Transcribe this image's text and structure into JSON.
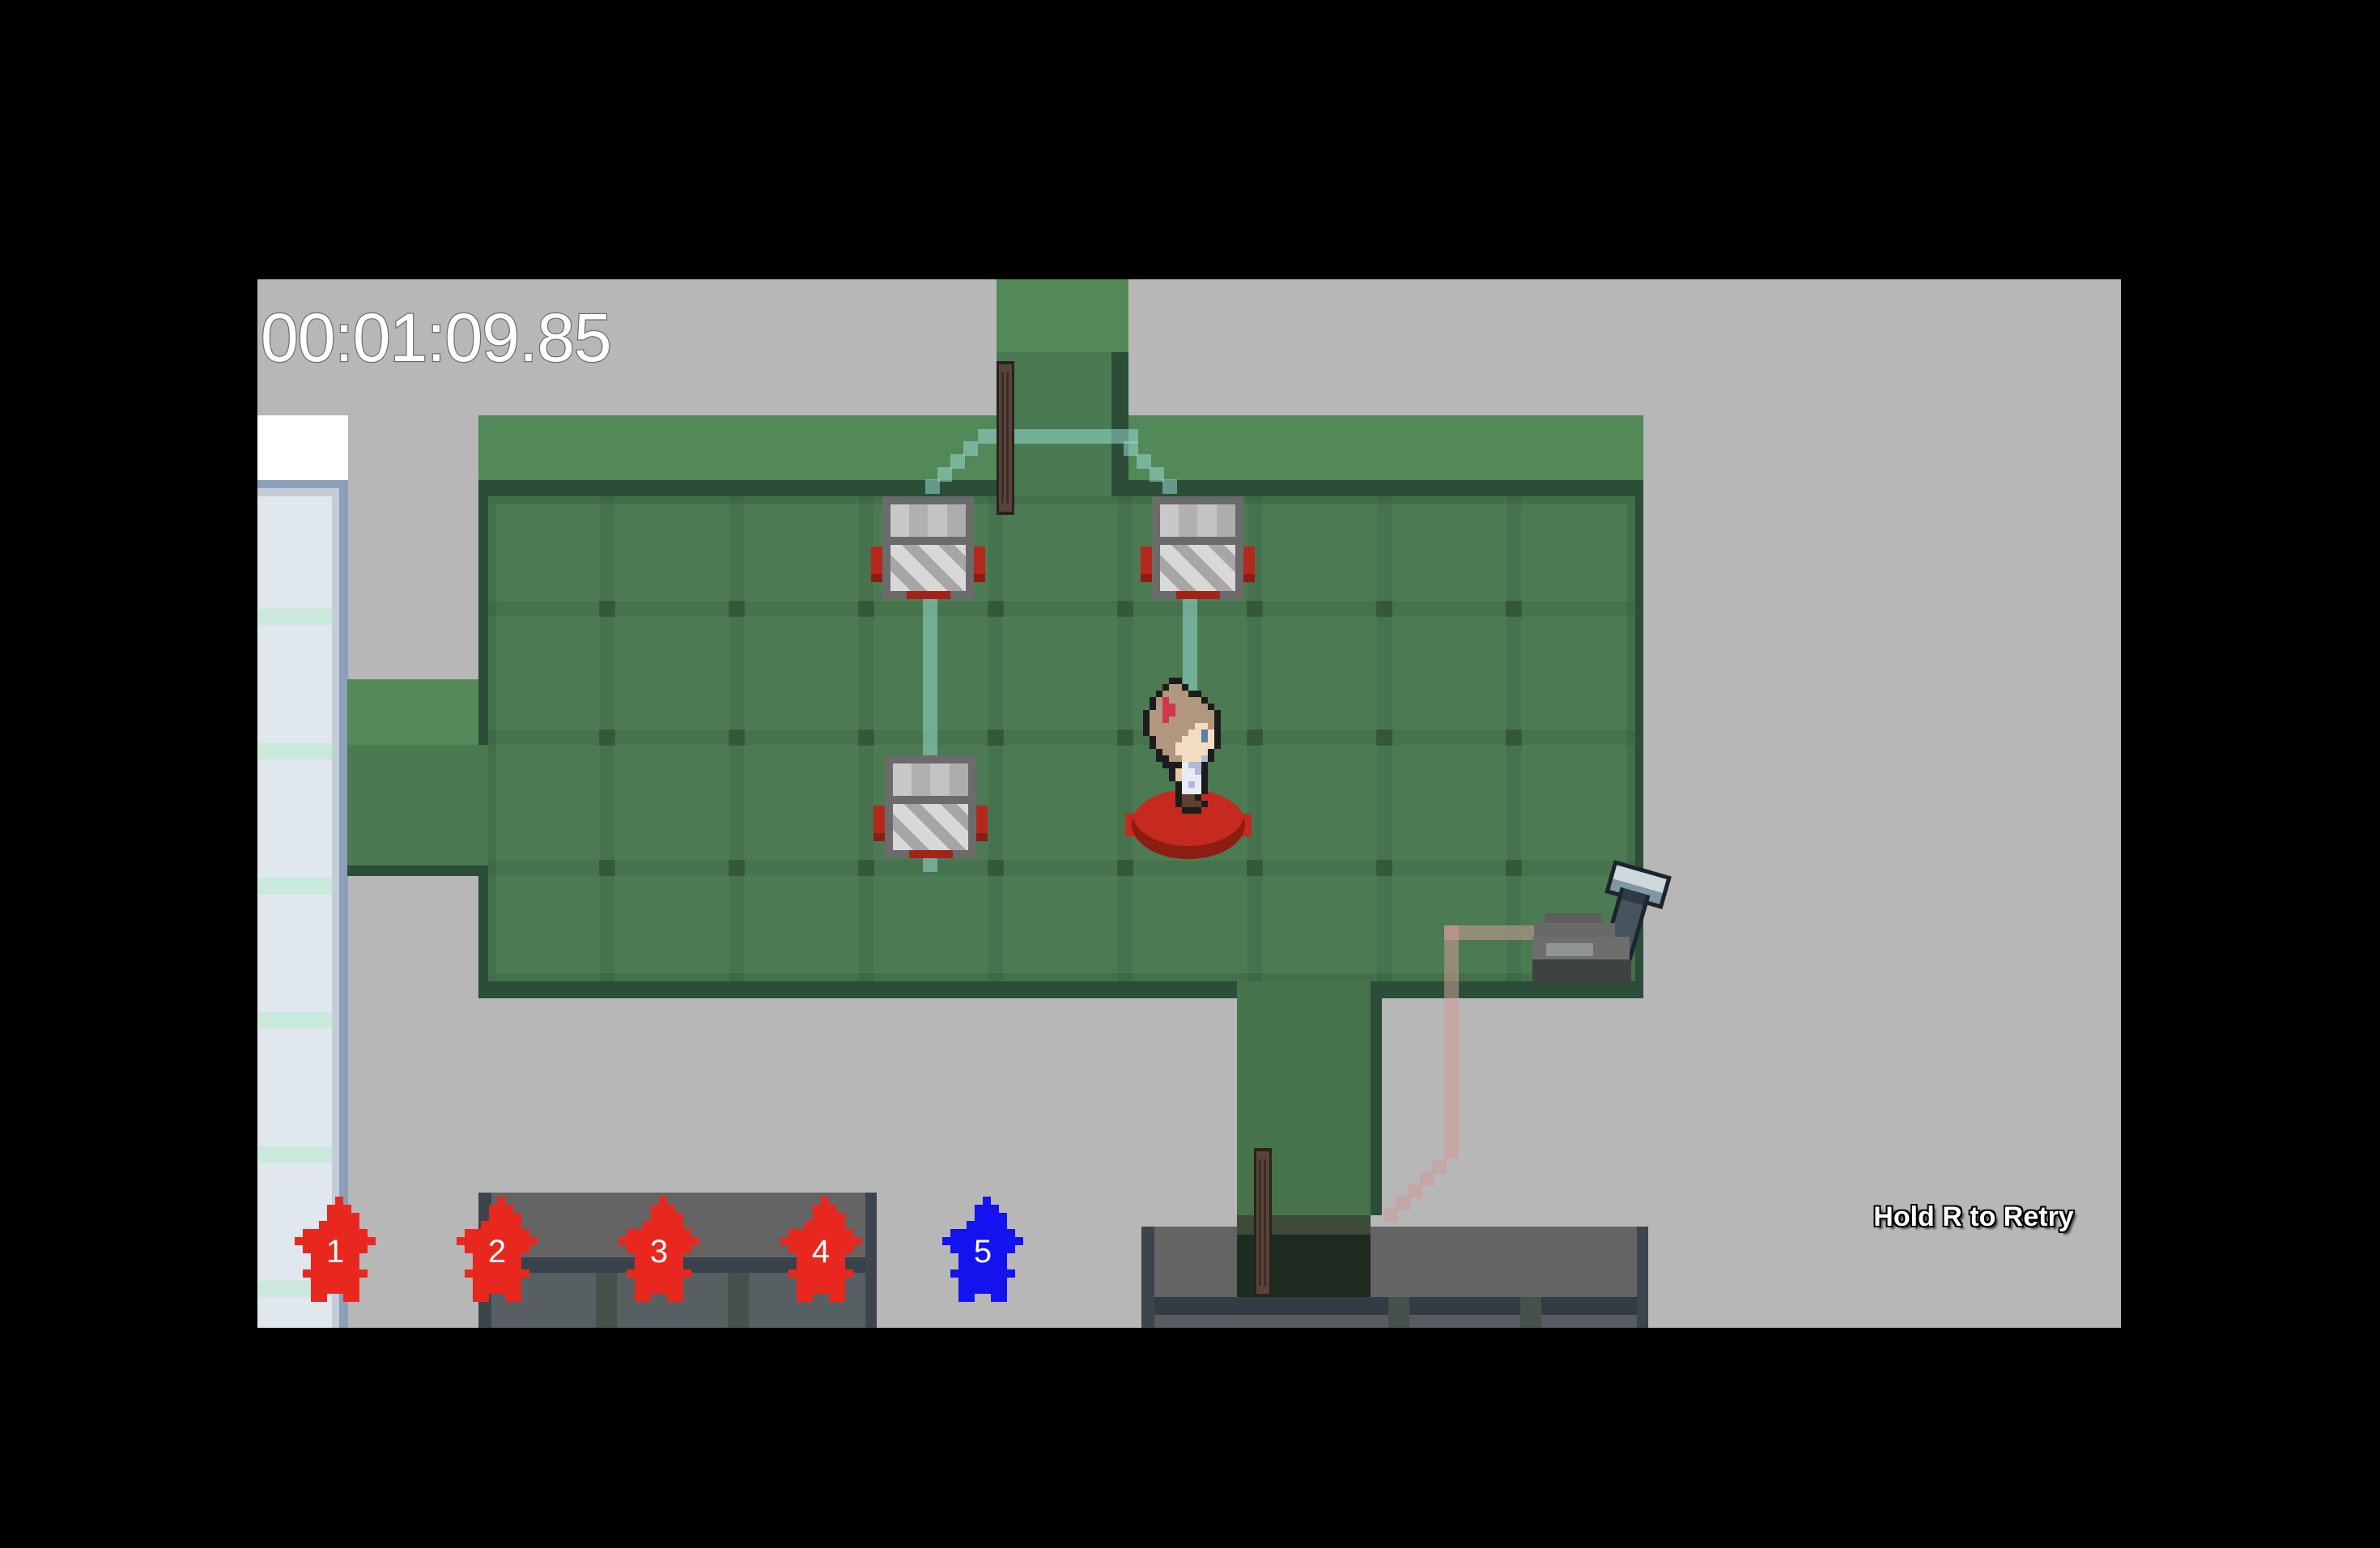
{
  "hud": {
    "timer": "00:01:09.85",
    "retry_hint": "Hold R to Retry"
  },
  "markers": {
    "items": [
      {
        "label": "1",
        "color": "#e8281e"
      },
      {
        "label": "2",
        "color": "#e8281e"
      },
      {
        "label": "3",
        "color": "#e8281e"
      },
      {
        "label": "4",
        "color": "#e8281e"
      },
      {
        "label": "5",
        "color": "#1412ee"
      }
    ]
  },
  "entities": {
    "player": "girl-character-on-button",
    "machines": [
      "machine-top-left",
      "machine-top-right",
      "machine-bottom-left"
    ],
    "doors": [
      "top-corridor-door",
      "bottom-corridor-door"
    ],
    "lever": "lever-switch",
    "button": "red-floor-button"
  },
  "colors": {
    "background_gray": "#b7b7b8",
    "floor_green": "#4b7a53",
    "floor_light_band": "#538859",
    "floor_border": "#2c4d38",
    "pale_wall": "#e0e7ed",
    "wall_frame_blue": "#8ba0b8",
    "trail_teal": "rgba(150,216,208,0.55)",
    "trail_pink": "rgba(208,156,151,0.55)",
    "button_red": "#c62a1e",
    "marker_red": "#e8281e",
    "marker_blue": "#1412ee"
  }
}
